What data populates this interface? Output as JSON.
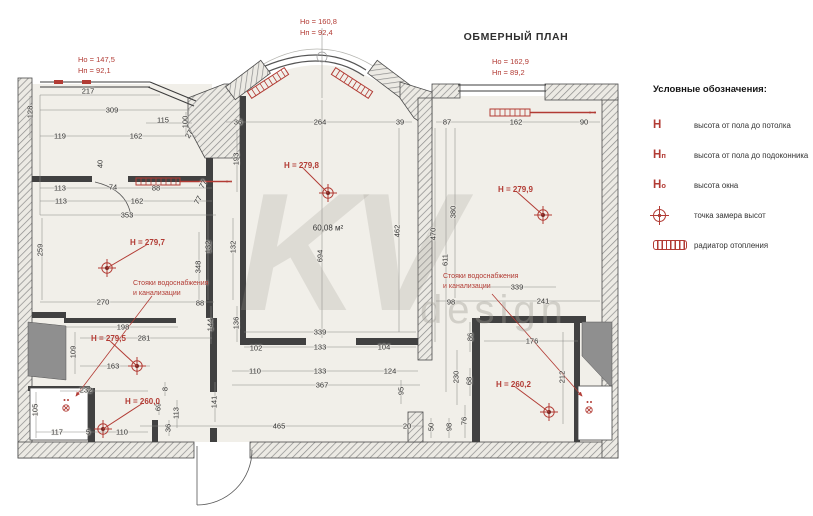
{
  "title": "ОБМЕРНЫЙ ПЛАН",
  "watermark": {
    "big": "KV",
    "small": "design"
  },
  "area_label": "60,08 м²",
  "legend": {
    "heading": "Условные обозначения:",
    "items": [
      {
        "symbol": "H",
        "label": "высота от пола до потолка"
      },
      {
        "symbol": "Hп",
        "label": "высота от пола до подоконника"
      },
      {
        "symbol": "Hо",
        "label": "высота окна"
      },
      {
        "symbol": "point",
        "label": "точка замера высот"
      },
      {
        "symbol": "radiator",
        "label": "радиатор отопления"
      }
    ]
  },
  "window_notes": [
    {
      "lines": [
        "Hо = 147,5",
        "Hп = 92,1"
      ],
      "x": 78,
      "y": 54
    },
    {
      "lines": [
        "Hо = 160,8",
        "Hп = 92,4"
      ],
      "x": 300,
      "y": 16
    },
    {
      "lines": [
        "Hо = 162,9",
        "Hп = 89,2"
      ],
      "x": 492,
      "y": 56
    }
  ],
  "notes": [
    {
      "lines": [
        "Стояки водоснабжения",
        "и канализации"
      ],
      "x": 133,
      "y": 279
    },
    {
      "lines": [
        "Стояки водоснабжения",
        "и канализации"
      ],
      "x": 443,
      "y": 272
    }
  ],
  "height_markers": [
    {
      "text": "H = 279,7",
      "x": 130,
      "y": 238,
      "px": 107,
      "py": 268
    },
    {
      "text": "H = 279,8",
      "x": 284,
      "y": 161,
      "px": 328,
      "py": 193
    },
    {
      "text": "H = 279,9",
      "x": 498,
      "y": 185,
      "px": 543,
      "py": 215
    },
    {
      "text": "H = 279,5",
      "x": 91,
      "y": 334,
      "px": 137,
      "py": 366
    },
    {
      "text": "H = 260,0",
      "x": 125,
      "y": 397,
      "px": 103,
      "py": 429
    },
    {
      "text": "H = 260,2",
      "x": 496,
      "y": 380,
      "px": 549,
      "py": 412
    }
  ],
  "dims": [
    {
      "t": "217",
      "x": 88,
      "y": 91
    },
    {
      "t": "309",
      "x": 112,
      "y": 110
    },
    {
      "t": "115",
      "x": 163,
      "y": 120
    },
    {
      "t": "100",
      "x": 185,
      "y": 122,
      "v": 1
    },
    {
      "t": "119",
      "x": 60,
      "y": 136
    },
    {
      "t": "162",
      "x": 136,
      "y": 136
    },
    {
      "t": "27",
      "x": 189,
      "y": 134,
      "r": -60
    },
    {
      "t": "128",
      "x": 30,
      "y": 112,
      "v": 1
    },
    {
      "t": "40",
      "x": 100,
      "y": 164,
      "v": 1
    },
    {
      "t": "193",
      "x": 236,
      "y": 159,
      "v": 1
    },
    {
      "t": "113",
      "x": 60,
      "y": 188
    },
    {
      "t": "74",
      "x": 113,
      "y": 187
    },
    {
      "t": "88",
      "x": 156,
      "y": 188
    },
    {
      "t": "77",
      "x": 203,
      "y": 184,
      "r": -60
    },
    {
      "t": "113",
      "x": 61,
      "y": 201
    },
    {
      "t": "162",
      "x": 137,
      "y": 201
    },
    {
      "t": "77",
      "x": 198,
      "y": 200,
      "r": -60
    },
    {
      "t": "353",
      "x": 127,
      "y": 215
    },
    {
      "t": "259",
      "x": 40,
      "y": 250,
      "v": 1
    },
    {
      "t": "132",
      "x": 208,
      "y": 247,
      "v": 1
    },
    {
      "t": "132",
      "x": 233,
      "y": 247,
      "v": 1
    },
    {
      "t": "348",
      "x": 198,
      "y": 267,
      "v": 1
    },
    {
      "t": "270",
      "x": 103,
      "y": 302
    },
    {
      "t": "88",
      "x": 200,
      "y": 303
    },
    {
      "t": "198",
      "x": 123,
      "y": 327
    },
    {
      "t": "281",
      "x": 144,
      "y": 338
    },
    {
      "t": "109",
      "x": 73,
      "y": 352,
      "v": 1
    },
    {
      "t": "163",
      "x": 113,
      "y": 366
    },
    {
      "t": "105",
      "x": 35,
      "y": 410,
      "v": 1
    },
    {
      "t": "232",
      "x": 86,
      "y": 390
    },
    {
      "t": "117",
      "x": 57,
      "y": 432
    },
    {
      "t": "5",
      "x": 88,
      "y": 432
    },
    {
      "t": "110",
      "x": 122,
      "y": 432
    },
    {
      "t": "8",
      "x": 165,
      "y": 389,
      "v": 1
    },
    {
      "t": "69",
      "x": 158,
      "y": 407,
      "v": 1
    },
    {
      "t": "113",
      "x": 176,
      "y": 413,
      "v": 1
    },
    {
      "t": "36",
      "x": 168,
      "y": 428,
      "v": 1
    },
    {
      "t": "141",
      "x": 214,
      "y": 402,
      "v": 1
    },
    {
      "t": "144",
      "x": 210,
      "y": 325,
      "v": 1
    },
    {
      "t": "136",
      "x": 236,
      "y": 323,
      "v": 1
    },
    {
      "t": "36",
      "x": 238,
      "y": 122
    },
    {
      "t": "264",
      "x": 320,
      "y": 122
    },
    {
      "t": "39",
      "x": 400,
      "y": 122
    },
    {
      "t": "694",
      "x": 320,
      "y": 256,
      "v": 1
    },
    {
      "t": "339",
      "x": 320,
      "y": 332
    },
    {
      "t": "102",
      "x": 256,
      "y": 348
    },
    {
      "t": "133",
      "x": 320,
      "y": 347
    },
    {
      "t": "104",
      "x": 384,
      "y": 347
    },
    {
      "t": "110",
      "x": 255,
      "y": 371
    },
    {
      "t": "133",
      "x": 320,
      "y": 371
    },
    {
      "t": "124",
      "x": 390,
      "y": 371
    },
    {
      "t": "367",
      "x": 322,
      "y": 385
    },
    {
      "t": "465",
      "x": 279,
      "y": 426
    },
    {
      "t": "95",
      "x": 401,
      "y": 391,
      "v": 1
    },
    {
      "t": "20",
      "x": 407,
      "y": 426
    },
    {
      "t": "50",
      "x": 431,
      "y": 427,
      "v": 1
    },
    {
      "t": "98",
      "x": 449,
      "y": 427,
      "v": 1
    },
    {
      "t": "462",
      "x": 397,
      "y": 231,
      "v": 1
    },
    {
      "t": "87",
      "x": 447,
      "y": 122
    },
    {
      "t": "162",
      "x": 516,
      "y": 122
    },
    {
      "t": "90",
      "x": 584,
      "y": 122
    },
    {
      "t": "380",
      "x": 453,
      "y": 212,
      "v": 1
    },
    {
      "t": "470",
      "x": 433,
      "y": 234,
      "v": 1
    },
    {
      "t": "611",
      "x": 445,
      "y": 260,
      "v": 1
    },
    {
      "t": "98",
      "x": 451,
      "y": 302
    },
    {
      "t": "339",
      "x": 517,
      "y": 287
    },
    {
      "t": "241",
      "x": 543,
      "y": 301
    },
    {
      "t": "86",
      "x": 470,
      "y": 337,
      "v": 1
    },
    {
      "t": "176",
      "x": 532,
      "y": 341
    },
    {
      "t": "230",
      "x": 456,
      "y": 377,
      "v": 1
    },
    {
      "t": "68",
      "x": 469,
      "y": 381,
      "v": 1
    },
    {
      "t": "212",
      "x": 562,
      "y": 377,
      "v": 1
    },
    {
      "t": "76",
      "x": 464,
      "y": 421,
      "v": 1
    }
  ]
}
